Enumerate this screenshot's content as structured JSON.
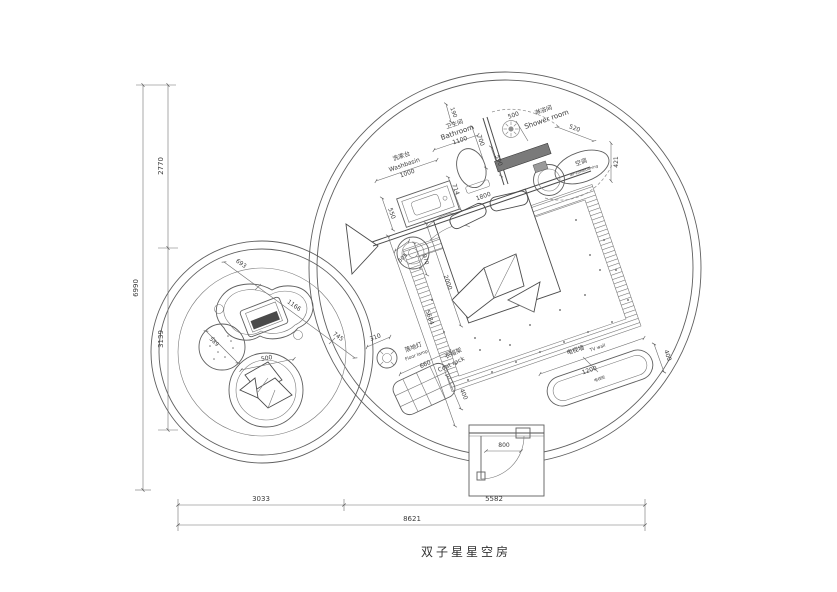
{
  "title": "双子星星空房",
  "labels": {
    "washbasin_zh": "洗漱台",
    "washbasin_en": "Washbasin",
    "bathroom_zh": "卫生间",
    "bathroom_en": "Bathroom",
    "shower_zh": "淋浴间",
    "shower_en": "Shower room",
    "ac_zh": "空调",
    "ac_en": "air-conditioning",
    "floor_lamp_zh": "落地灯",
    "floor_lamp_en": "Floor lamp",
    "coat_rack_zh": "衣帽架",
    "coat_rack_en": "Coat rack",
    "tv_wall_zh": "电视墙",
    "tv_wall_en": "TV wall",
    "tv_cabinet": "电视柜"
  },
  "dims": {
    "overall_h": "6990",
    "seg_top": "2770",
    "seg_bottom": "3139",
    "bottom_left": "3033",
    "bottom_right": "5582",
    "overall_w": "8621",
    "wall_stub": "190",
    "bathroom_w": "1100",
    "bathroom_d": "700",
    "shower_w": "500",
    "shower_d": "590",
    "ac_side": "520",
    "ac_d": "421",
    "washbasin_w": "1000",
    "washbasin_d": "550",
    "toilet_off": "714",
    "wall_diag": "1800",
    "stool_d": "505",
    "stool_off": "970",
    "bed_w": "2000",
    "room_diag": "5684",
    "deck_a": "693",
    "deck_b": "1166",
    "deck_c": "745",
    "pouf_d": "589",
    "chair_d": "500",
    "lamp_d": "310",
    "coat_w": "660",
    "coat_d": "400",
    "tv_w": "1200",
    "tv_d": "400",
    "door_w": "800"
  }
}
